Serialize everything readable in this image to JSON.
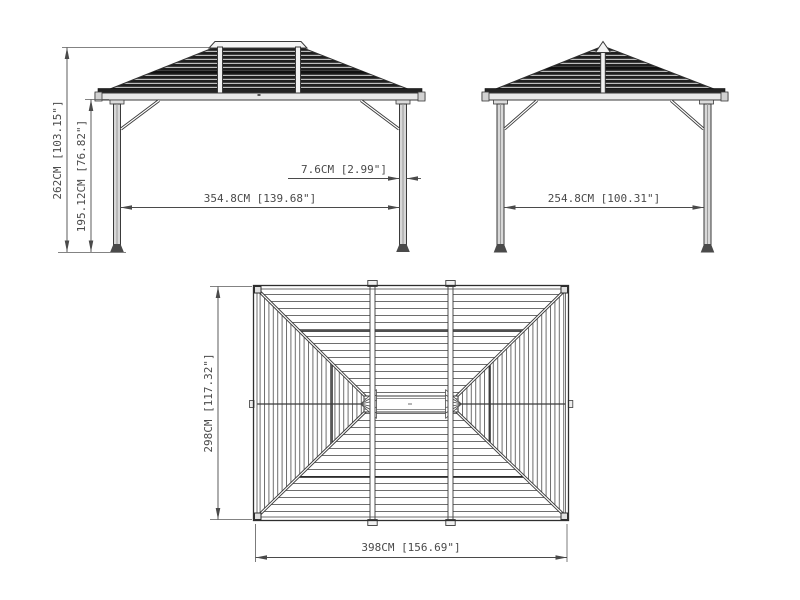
{
  "drawing": {
    "front_view": {
      "label_overall_height": "262CM [103.15\"]",
      "label_post_height": "195.12CM [76.82\"]",
      "label_span": "354.8CM [139.68\"]",
      "label_post_width": "7.6CM [2.99\"]"
    },
    "side_view": {
      "label_span": "254.8CM [100.31\"]"
    },
    "top_view": {
      "label_depth": "298CM [117.32\"]",
      "label_width": "398CM [156.69\"]"
    },
    "colors": {
      "background": "#ffffff",
      "line": "#4a4a4a",
      "roof_dark": "#1f1f1f",
      "metal_light": "#e8e8e8"
    }
  }
}
